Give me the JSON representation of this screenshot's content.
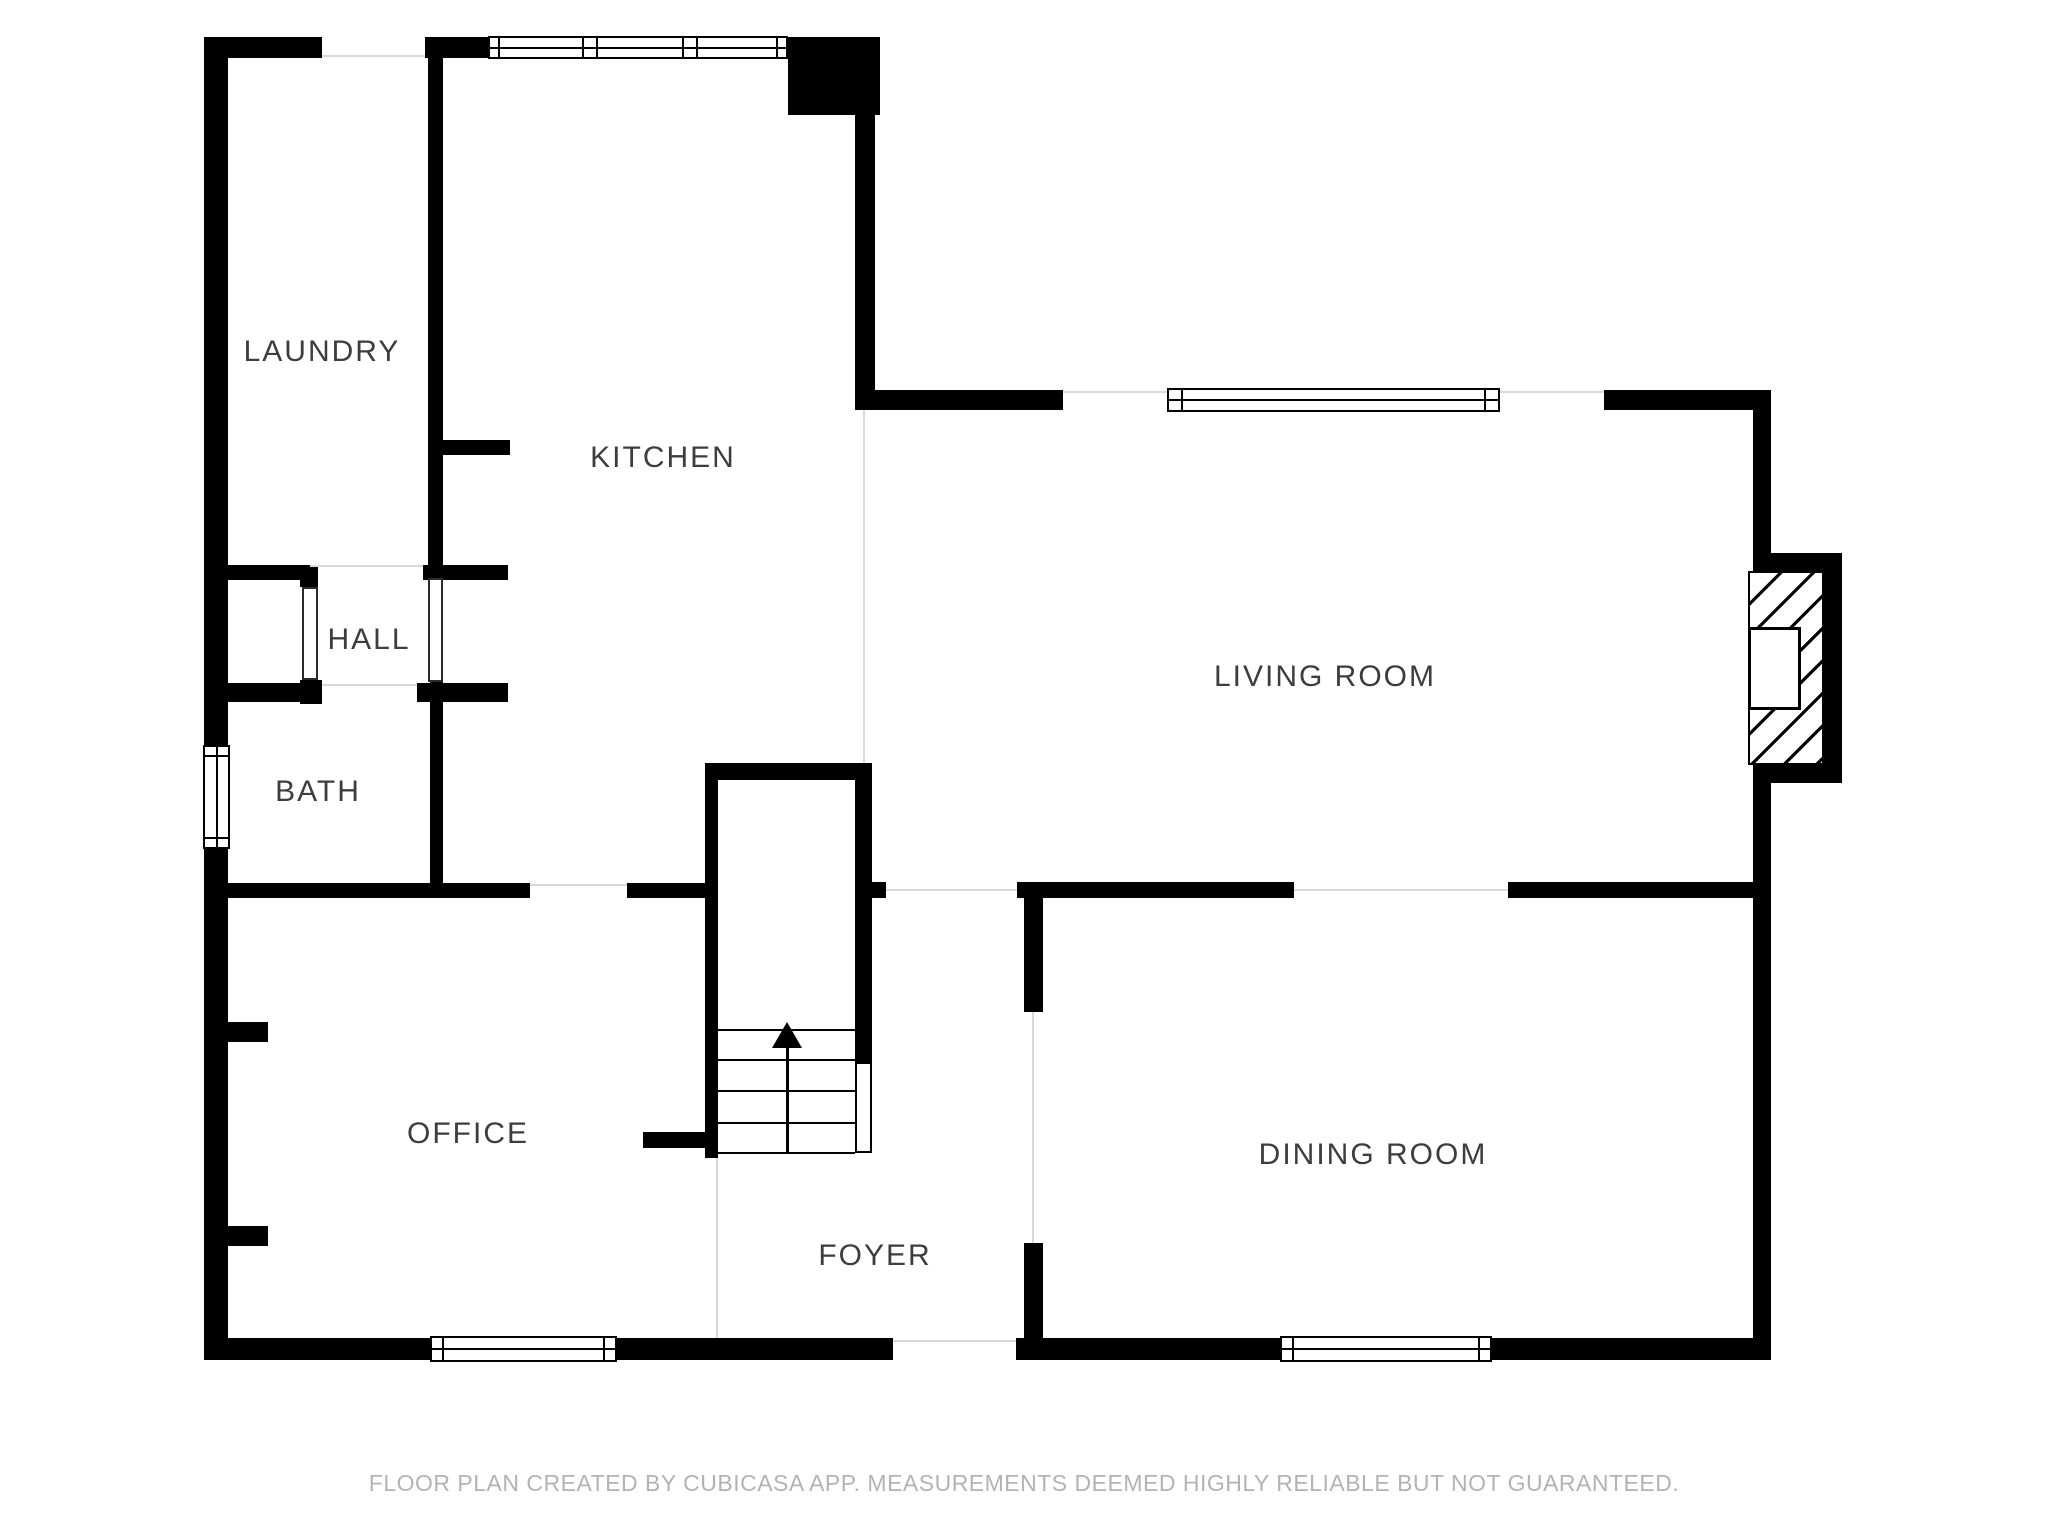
{
  "floor_plan": {
    "rooms": [
      {
        "id": "laundry",
        "label": "LAUNDRY"
      },
      {
        "id": "kitchen",
        "label": "KITCHEN"
      },
      {
        "id": "hall",
        "label": "HALL"
      },
      {
        "id": "bath",
        "label": "BATH"
      },
      {
        "id": "living_room",
        "label": "LIVING ROOM"
      },
      {
        "id": "office",
        "label": "OFFICE"
      },
      {
        "id": "foyer",
        "label": "FOYER"
      },
      {
        "id": "dining_room",
        "label": "DINING ROOM"
      }
    ],
    "stairs": {
      "direction": "up",
      "icon": "up-arrow"
    },
    "disclaimer": "FLOOR PLAN CREATED BY CUBICASA APP. MEASUREMENTS DEEMED HIGHLY RELIABLE BUT NOT GUARANTEED.",
    "colors": {
      "wall": "#000000",
      "background": "#ffffff",
      "room_label": "#3d3d3d",
      "disclaimer_text": "#b3b3b3",
      "opening_line": "#dadada"
    }
  }
}
